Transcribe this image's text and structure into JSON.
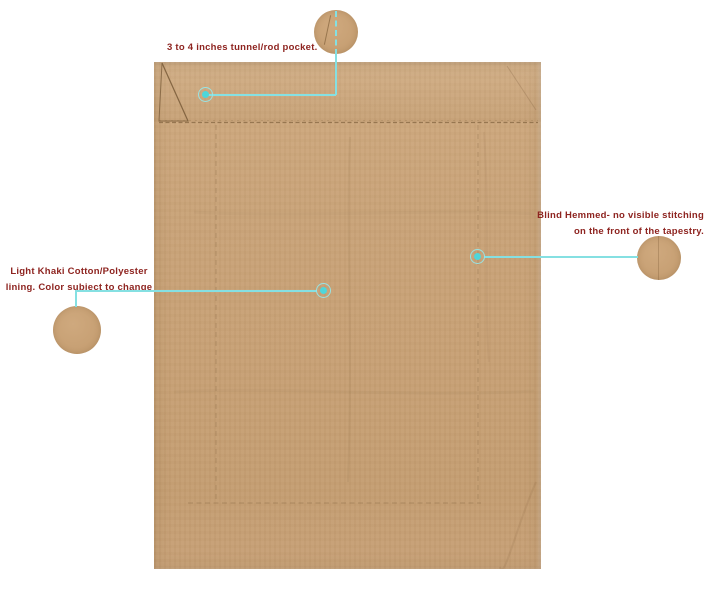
{
  "annotations": {
    "rod_pocket": {
      "label": "3 to 4 inches tunnel/rod pocket."
    },
    "blind_hem": {
      "line1": "Blind Hemmed- no visible stitching",
      "line2": "on the front of the tapestry."
    },
    "lining": {
      "line1": "Light Khaki Cotton/Polyester",
      "line2": "lining. Color subject to change"
    }
  },
  "colors": {
    "page_bg": "#ffffff",
    "fabric": "#c8a277",
    "fabric_light": "#d3ae84",
    "stitch": "#8a6a45",
    "callout_line": "#85e0e2",
    "callout_dot": "#4ed6da",
    "text_red": "#8e2420"
  }
}
